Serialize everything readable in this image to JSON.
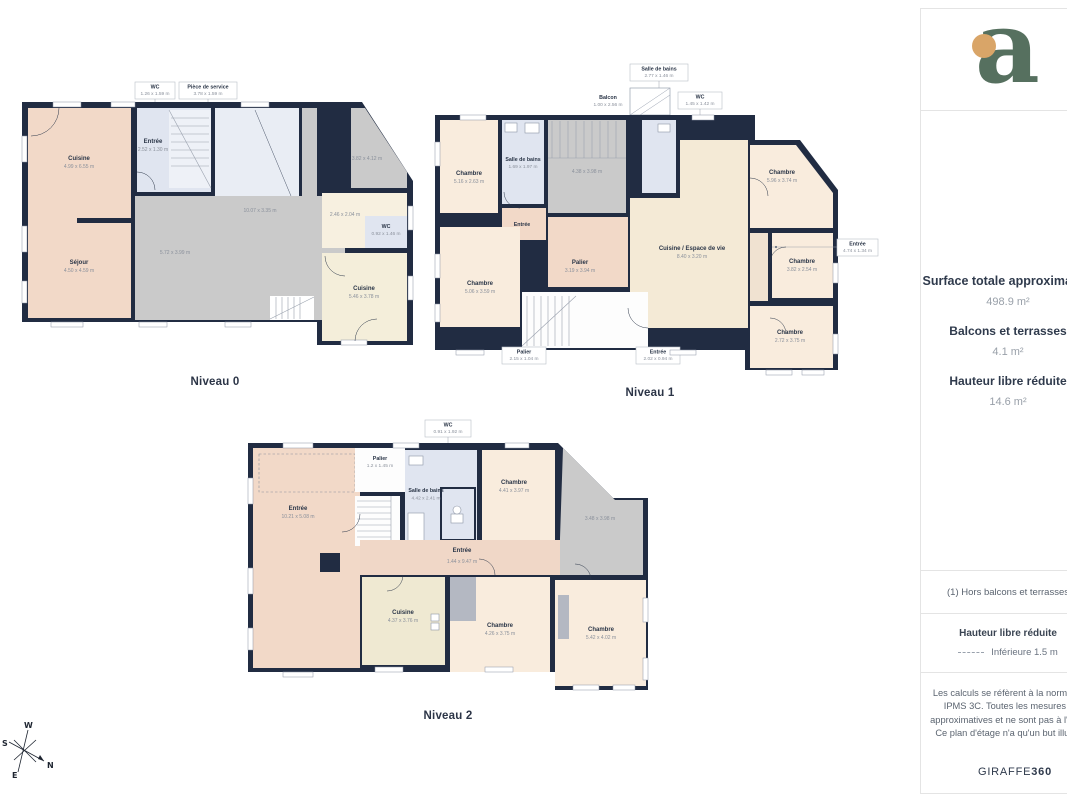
{
  "logo": {
    "letter": "a"
  },
  "sidebar": {
    "surface_title": "Surface totale approximative",
    "surface_value": "498.9 m²",
    "balcony_title": "Balcons et terrasses",
    "balcony_value": "4.1 m²",
    "reduced_title": "Hauteur libre réduite",
    "reduced_value": "14.6 m²",
    "note": "(1) Hors balcons et terrasses",
    "legend_title": "Hauteur libre réduite",
    "legend_item": "Inférieure 1.5 m",
    "disclaimer": "Les calculs se réfèrent à la norme RICS IPMS 3C. Toutes les mesures sont approximatives et ne sont pas à l'échelle. Ce plan d'étage n'a qu'un but illustratif.",
    "brand": "GIRAFFE",
    "brand_suffix": "360"
  },
  "compass": {
    "n": "N",
    "s": "S",
    "e": "E",
    "w": "W"
  },
  "colors": {
    "wall": "#212c42",
    "room_pink": "#f2d9c8",
    "room_cream": "#f9ecdd",
    "room_beige": "#f4ead6",
    "room_blue": "#e0e5f0",
    "room_gray": "#cacaca",
    "logo_green": "#56705f",
    "logo_dot": "#d9a568"
  },
  "levels": [
    {
      "label": "Niveau 0",
      "rooms": [
        {
          "name": "Cuisine",
          "dims": "4.99 x 6.55 m"
        },
        {
          "name": "Séjour",
          "dims": "4.50 x 4.59 m"
        },
        {
          "name": "Entrée",
          "dims": "2.52 x 1.30 m"
        },
        {
          "name": "",
          "dims": "10.07 x 3.35 m"
        },
        {
          "name": "",
          "dims": "5.72 x 3.99 m"
        },
        {
          "name": "",
          "dims": "3.82 x 4.12 m"
        },
        {
          "name": "",
          "dims": "2.46 x 2.04 m"
        },
        {
          "name": "WC",
          "dims": "0.92 x 1.46 m"
        },
        {
          "name": "Cuisine",
          "dims": "5.46 x 3.78 m"
        }
      ],
      "callouts": [
        {
          "name": "WC",
          "dims": "1.26 x 1.59 m"
        },
        {
          "name": "Pièce de service",
          "dims": "3.78 x 1.59 m"
        }
      ]
    },
    {
      "label": "Niveau 1",
      "rooms": [
        {
          "name": "Chambre",
          "dims": "5.16 x 2.63 m"
        },
        {
          "name": "Salle de bains",
          "dims": "1.69 x 1.97 m"
        },
        {
          "name": "",
          "dims": "4.38 x 3.98 m"
        },
        {
          "name": "Chambre",
          "dims": "5.06 x 3.59 m"
        },
        {
          "name": "Palier",
          "dims": "3.19 x 3.94 m"
        },
        {
          "name": "Cuisine / Espace de vie",
          "dims": "8.40 x 3.20 m"
        },
        {
          "name": "Chambre",
          "dims": "5.96 x 3.74 m"
        },
        {
          "name": "Chambre",
          "dims": "3.82 x 2.54 m"
        },
        {
          "name": "Chambre",
          "dims": "2.72 x 3.75 m"
        },
        {
          "name": "Entrée",
          "dims": ""
        }
      ],
      "callouts": [
        {
          "name": "Salle de bains",
          "dims": "2.77 x 1.46 m"
        },
        {
          "name": "Balcon",
          "dims": "1.00 x 2.56 m"
        },
        {
          "name": "WC",
          "dims": "1.45 x 1.42 m"
        },
        {
          "name": "Entrée",
          "dims": "4.74 x 1.34 m"
        },
        {
          "name": "Palier",
          "dims": "2.15 x 1.04 m"
        },
        {
          "name": "Entrée",
          "dims": "2.02 x 0.94 m"
        }
      ]
    },
    {
      "label": "Niveau 2",
      "rooms": [
        {
          "name": "Entrée",
          "dims": "10.21 x 5.08 m"
        },
        {
          "name": "Palier",
          "dims": "1.2 x 1.45 m"
        },
        {
          "name": "Salle de bains",
          "dims": "4.42 x 2.41 m"
        },
        {
          "name": "Chambre",
          "dims": "4.41 x 3.97 m"
        },
        {
          "name": "",
          "dims": "3.48 x 3.98 m"
        },
        {
          "name": "Entrée",
          "dims": "1.44 x 9.47 m"
        },
        {
          "name": "Cuisine",
          "dims": "4.37 x 3.76 m"
        },
        {
          "name": "Chambre",
          "dims": "4.26 x 3.75 m"
        },
        {
          "name": "Chambre",
          "dims": "5.42 x 4.02 m"
        }
      ],
      "callouts": [
        {
          "name": "WC",
          "dims": "0.91 x 1.92 m"
        }
      ]
    }
  ]
}
